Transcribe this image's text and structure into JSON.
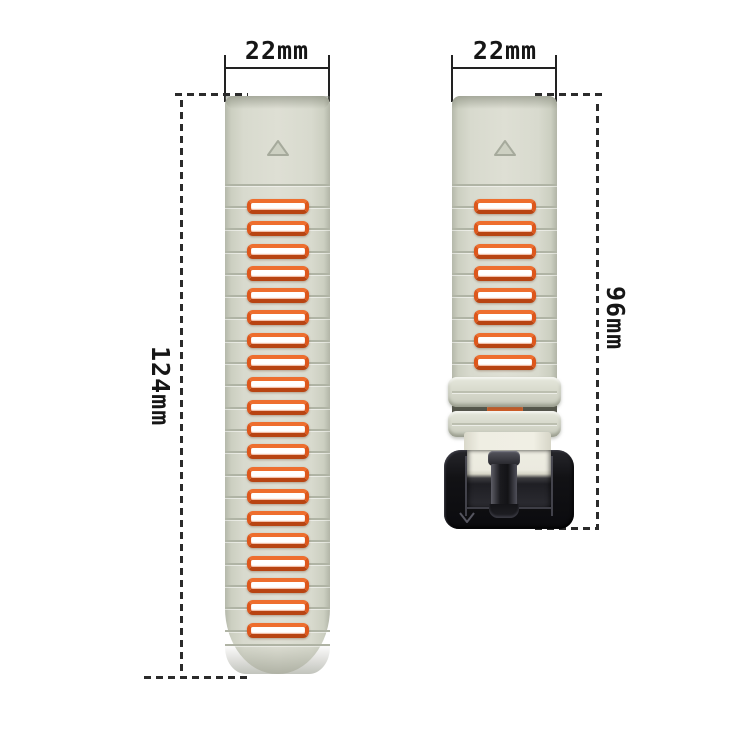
{
  "figure": {
    "title": "watch band size diagram",
    "left_strap": {
      "width_label": "22mm",
      "length_label": "124mm",
      "segment_count": 20,
      "marker": "triangle-up-icon"
    },
    "right_strap": {
      "width_label": "22mm",
      "length_label": "96mm",
      "segment_count": 8,
      "marker": "triangle-up-icon",
      "buckle_logo": "v-logo"
    },
    "colors": {
      "strap_gray": "#d6d8cc",
      "accent_orange": "#dd571c",
      "buckle_black": "#121215",
      "cream_end": "#eeede2",
      "annotation_ink": "#222222"
    }
  }
}
